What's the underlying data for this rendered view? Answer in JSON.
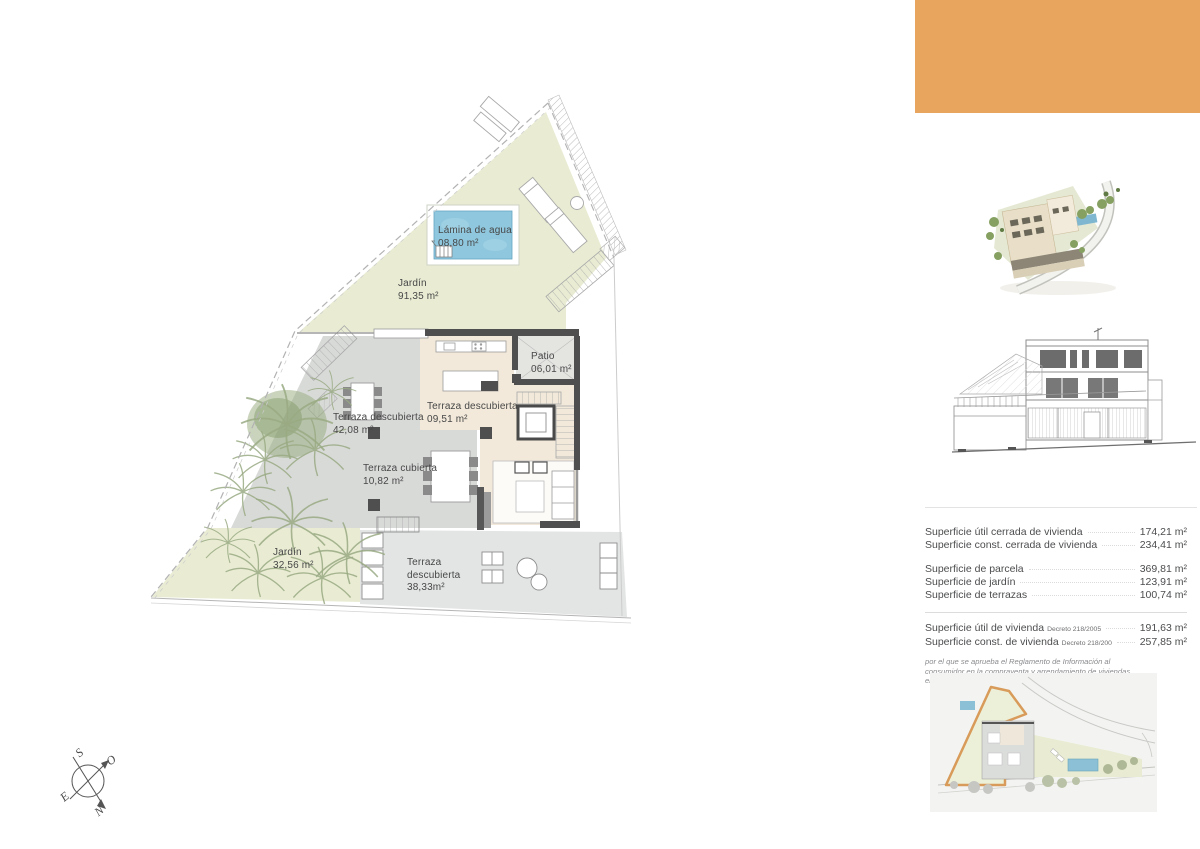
{
  "brand": {
    "accent_color": "#e7a55e",
    "plot_outline_color": "#d89b59"
  },
  "floor_plan": {
    "labels": {
      "lamina": {
        "name": "Lámina de agua",
        "area": "08,80 m²"
      },
      "jardin_top": {
        "name": "Jardín",
        "area": "91,35 m²"
      },
      "patio": {
        "name": "Patio",
        "area": "06,01 m²"
      },
      "terraza_izquierda": {
        "name": "Terraza  descubierta",
        "area": "42,08 m²"
      },
      "terraza_centro": {
        "name": "Terraza descubierta",
        "area": "09,51 m²"
      },
      "terraza_cubierta": {
        "name": "Terraza cubierta",
        "area": "10,82 m²"
      },
      "jardin_inferior": {
        "name": "Jardín",
        "area": "32,56 m²"
      },
      "terraza_inferior": {
        "line1": "Terraza",
        "line2": "descubierta",
        "line3": "38,33m²"
      }
    }
  },
  "compass": {
    "n": "N",
    "s": "S",
    "e": "E",
    "w": "O"
  },
  "areas_table": {
    "group1": [
      {
        "label": "Superficie útil cerrada de vivienda",
        "value": "174,21 m²"
      },
      {
        "label": "Superficie const. cerrada de vivienda",
        "value": "234,41 m²"
      }
    ],
    "group2": [
      {
        "label": "Superficie de parcela",
        "value": "369,81 m²"
      },
      {
        "label": "Superficie de jardín",
        "value": "123,91 m²"
      },
      {
        "label": "Superficie de terrazas",
        "value": "100,74 m²"
      }
    ],
    "group3": [
      {
        "label": "Superficie útil de vivienda",
        "decree": "Decreto 218/2005",
        "value": "191,63 m²"
      },
      {
        "label": "Superficie const. de vivienda",
        "decree": "Decreto 218/200",
        "value": "257,85 m²"
      }
    ],
    "footnote": "por el que se aprueba el Reglamento de Información al consumidor en la compraventa y arrendamiento de viviendas en Andalucía"
  }
}
